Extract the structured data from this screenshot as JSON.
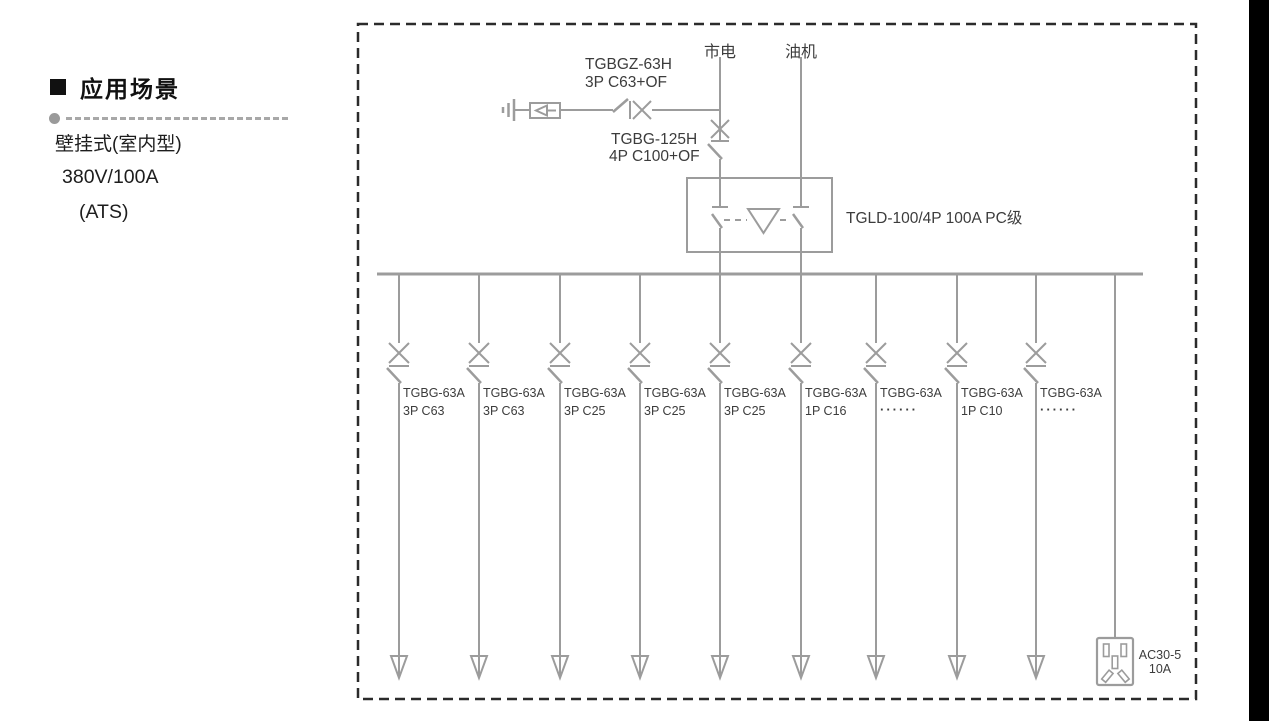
{
  "left_panel": {
    "heading": "应用场景",
    "lines": [
      "壁挂式(室内型)",
      "380V/100A",
      "(ATS)"
    ]
  },
  "diagram": {
    "sources": {
      "mains": "市电",
      "generator": "油机"
    },
    "spd_branch_breaker": {
      "line1": "TGBGZ-63H",
      "line2": "3P C63+OF"
    },
    "main_breaker": {
      "line1": "TGBG-125H",
      "line2": "4P C100+OF"
    },
    "ats": {
      "label": "TGLD-100/4P 100A PC级"
    },
    "branches": [
      {
        "model": "TGBG-63A",
        "spec": "3P C63"
      },
      {
        "model": "TGBG-63A",
        "spec": "3P C63"
      },
      {
        "model": "TGBG-63A",
        "spec": "3P C25"
      },
      {
        "model": "TGBG-63A",
        "spec": "3P C25"
      },
      {
        "model": "TGBG-63A",
        "spec": "3P C25"
      },
      {
        "model": "TGBG-63A",
        "spec": "1P C16"
      },
      {
        "model": "TGBG-63A",
        "spec": "······"
      },
      {
        "model": "TGBG-63A",
        "spec": "1P C10"
      },
      {
        "model": "TGBG-63A",
        "spec": "······"
      }
    ],
    "socket": {
      "line1": "AC30-5",
      "line2": "10A"
    }
  },
  "colors": {
    "line_gray": "#9c9c9c",
    "text_dark": "#3c3c3c",
    "panel_text": "#1d1d1d",
    "border_dark": "#2b2b2b",
    "black_bar": "#000000"
  }
}
